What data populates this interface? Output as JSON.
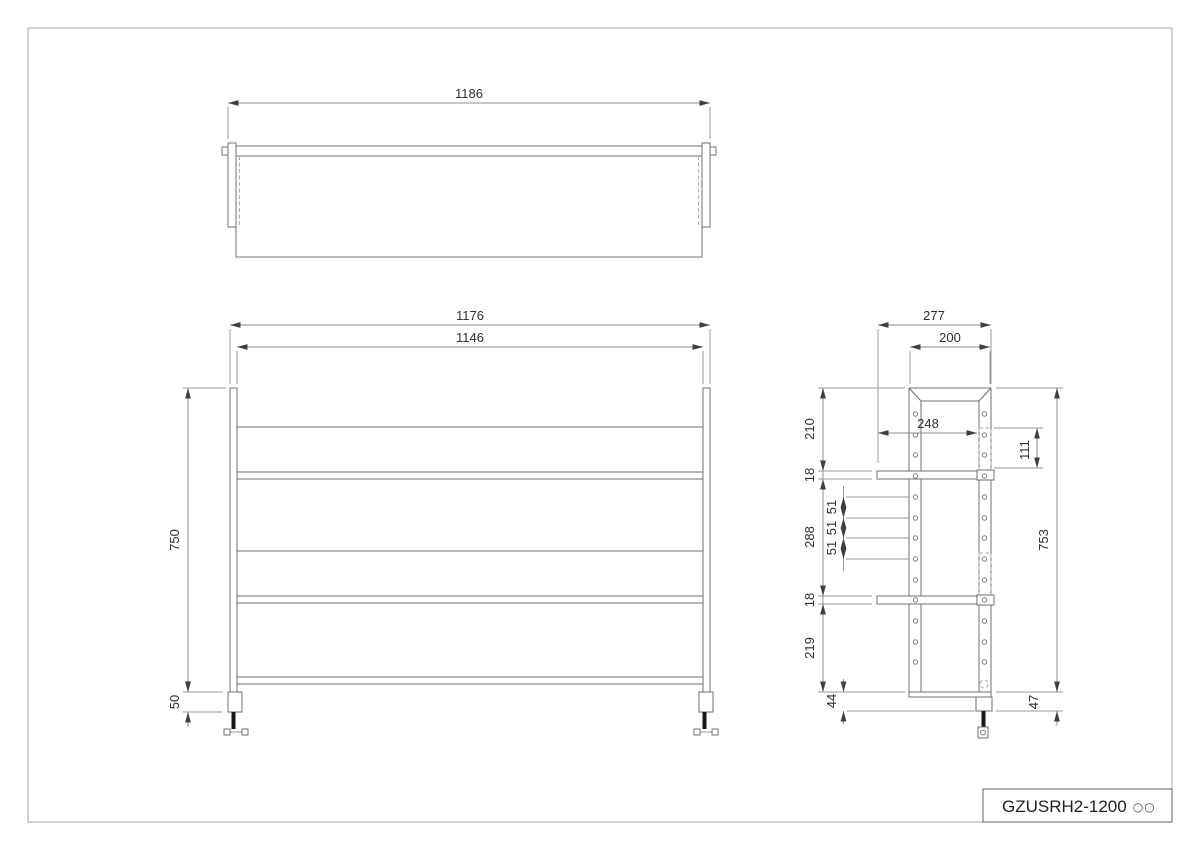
{
  "title_block": {
    "part_code": "GZUSRH2-1200",
    "option_marks": "○○"
  },
  "views": {
    "top": {
      "dims": {
        "overall_width": "1186"
      }
    },
    "front": {
      "dims": {
        "outer_width": "1176",
        "inner_width": "1146",
        "post_height": "750",
        "foot_height": "50"
      }
    },
    "side": {
      "dims": {
        "overall_depth": "277",
        "frame_depth": "200",
        "shelf_depth": "248",
        "bracket_length": "111",
        "top_offset": "210",
        "upper_shelf_thickness": "18",
        "hole_span": "288",
        "hole_pitch_1": "51",
        "hole_pitch_2": "51",
        "hole_pitch_3": "51",
        "lower_shelf_thickness": "18",
        "bottom_offset": "219",
        "foot_inset": "44",
        "frame_height": "753",
        "foot_height": "47"
      }
    }
  },
  "colors": {
    "line": "#6f6f6f",
    "dim_line": "#9a9a9a",
    "text": "#2f2f2f"
  }
}
